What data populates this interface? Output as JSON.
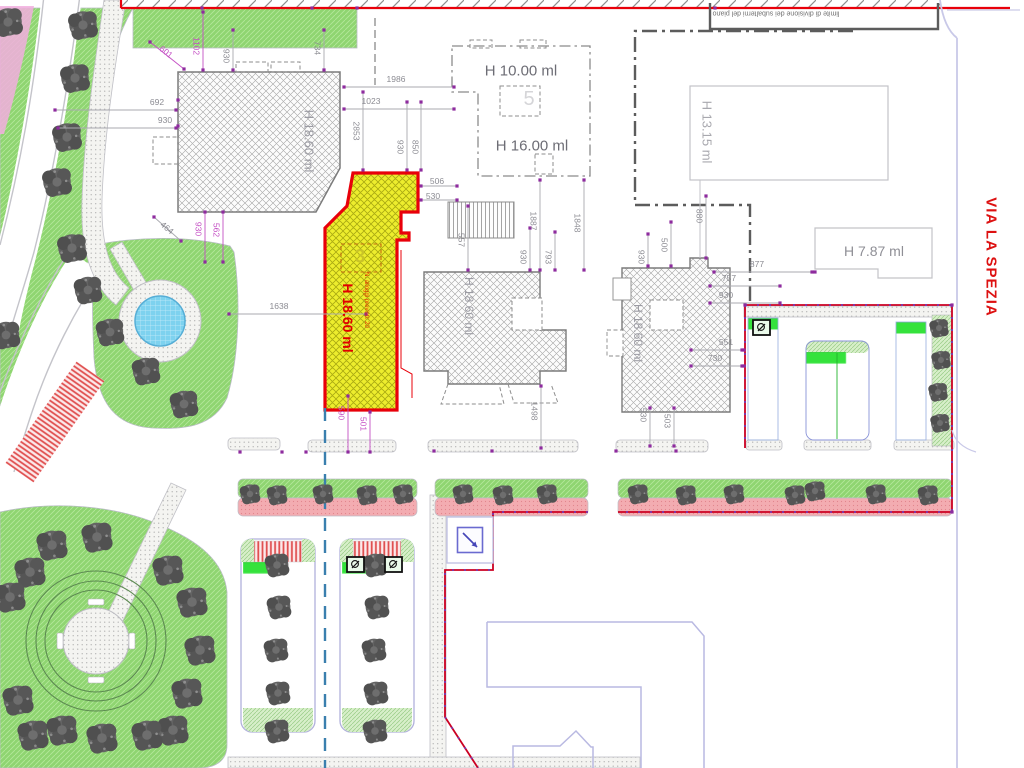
{
  "street": {
    "label": "VIA LA SPEZIA"
  },
  "boundary_note": {
    "text": "limite di divisione dei subalterni del piano"
  },
  "labels": [
    {
      "text": "H 18.60 ml",
      "x": 309,
      "y": 141,
      "rot": 90,
      "size": 13,
      "color": "#9b9ba3",
      "name": "building-nw-height-label"
    },
    {
      "text": "H 10.00 ml",
      "x": 521,
      "y": 71,
      "rot": 0,
      "size": 15,
      "color": "#6d6d75",
      "name": "building-h10-height-label"
    },
    {
      "text": "H 16.00 ml",
      "x": 532,
      "y": 146,
      "rot": 0,
      "size": 15,
      "color": "#6d6d75",
      "name": "building-h16-height-label"
    },
    {
      "text": "H 13.15 ml",
      "x": 707,
      "y": 132,
      "rot": 90,
      "size": 13,
      "color": "#a8a8ae",
      "name": "building-h1315-height-label"
    },
    {
      "text": "H 7.87 ml",
      "x": 874,
      "y": 251,
      "rot": 0,
      "size": 14,
      "color": "#8f8f96",
      "name": "building-h787-height-label"
    },
    {
      "text": "H 18.60 ml",
      "x": 469,
      "y": 306,
      "rot": 90,
      "size": 12,
      "color": "#9b9ba3",
      "name": "building-center-height-label"
    },
    {
      "text": "H 18.60 ml",
      "x": 638,
      "y": 333,
      "rot": 90,
      "size": 12,
      "color": "#9b9ba3",
      "name": "building-east-height-label"
    },
    {
      "text": "H 18.60 ml",
      "x": 348,
      "y": 318,
      "rot": 90,
      "size": 14,
      "color": "#e10000",
      "bold": true,
      "name": "new-building-height-label"
    },
    {
      "text": "N. alloggi previsti: 20",
      "x": 366,
      "y": 300,
      "rot": 90,
      "size": 6,
      "color": "#e13000",
      "name": "new-building-note"
    },
    {
      "text": "3",
      "x": 360,
      "y": 257,
      "rot": 0,
      "size": 19,
      "color": "#c9c427",
      "bold": true,
      "name": "unit-number-3"
    },
    {
      "text": "5",
      "x": 529,
      "y": 99,
      "rot": 0,
      "size": 20,
      "color": "#d5d5d8",
      "name": "unit-number-5"
    },
    {
      "text": "VIA LA SPEZIA",
      "x": 991,
      "y": 257,
      "rot": 90,
      "size": 15,
      "color": "#dd1111",
      "bold": true,
      "ls": 1,
      "name": "street-name-label"
    },
    {
      "text": "limite di divisione dei subalterni del piano",
      "x": 776,
      "y": 13,
      "rot": 180,
      "size": 7,
      "color": "#707070",
      "name": "division-boundary-note"
    }
  ],
  "dimensions": [
    {
      "t": "601",
      "x": 166,
      "y": 52,
      "r": 38,
      "c": "m",
      "l": [
        150,
        42,
        184,
        69
      ]
    },
    {
      "t": "1102",
      "x": 196,
      "y": 46,
      "r": 90,
      "c": "m",
      "l": [
        203,
        12,
        203,
        70
      ]
    },
    {
      "t": "930",
      "x": 226,
      "y": 56,
      "r": 90,
      "c": "g",
      "l": [
        233,
        30,
        233,
        70
      ]
    },
    {
      "t": "734",
      "x": 317,
      "y": 48,
      "r": 90,
      "c": "g",
      "l": [
        324,
        30,
        324,
        70
      ]
    },
    {
      "t": "692",
      "x": 157,
      "y": 102,
      "r": 0,
      "c": "g",
      "l": [
        55,
        110,
        176,
        110
      ]
    },
    {
      "t": "930",
      "x": 165,
      "y": 120,
      "r": 0,
      "c": "g",
      "l": [
        58,
        128,
        176,
        128
      ]
    },
    {
      "t": "1986",
      "x": 396,
      "y": 79,
      "r": 0,
      "c": "g",
      "l": [
        344,
        87,
        454,
        87
      ]
    },
    {
      "t": "1023",
      "x": 371,
      "y": 101,
      "r": 0,
      "c": "g",
      "l": [
        344,
        109,
        454,
        109
      ]
    },
    {
      "t": "2853",
      "x": 356,
      "y": 131,
      "r": 90,
      "c": "g",
      "l": [
        363,
        92,
        363,
        170
      ]
    },
    {
      "t": "930",
      "x": 400,
      "y": 147,
      "r": 90,
      "c": "g",
      "l": [
        407,
        102,
        407,
        170
      ]
    },
    {
      "t": "850",
      "x": 415,
      "y": 147,
      "r": 90,
      "c": "g",
      "l": [
        421,
        102,
        421,
        170
      ]
    },
    {
      "t": "506",
      "x": 437,
      "y": 181,
      "r": 0,
      "c": "g",
      "l": [
        421,
        186,
        457,
        186
      ]
    },
    {
      "t": "530",
      "x": 433,
      "y": 196,
      "r": 0,
      "c": "g",
      "l": [
        421,
        200,
        457,
        200
      ]
    },
    {
      "t": "464",
      "x": 167,
      "y": 228,
      "r": 40,
      "c": "g",
      "l": [
        154,
        217,
        181,
        241
      ]
    },
    {
      "t": "930",
      "x": 198,
      "y": 229,
      "r": 90,
      "c": "m",
      "l": [
        205,
        212,
        205,
        262
      ]
    },
    {
      "t": "562",
      "x": 216,
      "y": 230,
      "r": 90,
      "c": "m",
      "l": [
        223,
        212,
        223,
        262
      ]
    },
    {
      "t": "1638",
      "x": 279,
      "y": 306,
      "r": 0,
      "c": "g",
      "l": [
        229,
        314,
        366,
        314
      ]
    },
    {
      "t": "557",
      "x": 461,
      "y": 240,
      "r": 90,
      "c": "g",
      "l": [
        468,
        206,
        468,
        270
      ]
    },
    {
      "t": "930",
      "x": 523,
      "y": 257,
      "r": 90,
      "c": "g",
      "l": [
        530,
        228,
        530,
        270
      ]
    },
    {
      "t": "793",
      "x": 548,
      "y": 257,
      "r": 90,
      "c": "g",
      "l": [
        555,
        232,
        555,
        270
      ]
    },
    {
      "t": "1887",
      "x": 533,
      "y": 221,
      "r": 90,
      "c": "g",
      "l": [
        540,
        180,
        540,
        270
      ]
    },
    {
      "t": "1848",
      "x": 577,
      "y": 223,
      "r": 90,
      "c": "g",
      "l": [
        584,
        180,
        584,
        270
      ]
    },
    {
      "t": "1498",
      "x": 534,
      "y": 411,
      "r": 90,
      "c": "g",
      "l": [
        541,
        386,
        541,
        448
      ]
    },
    {
      "t": "500",
      "x": 664,
      "y": 245,
      "r": 90,
      "c": "g",
      "l": [
        671,
        222,
        671,
        266
      ]
    },
    {
      "t": "930",
      "x": 641,
      "y": 257,
      "r": 90,
      "c": "g",
      "l": [
        648,
        234,
        648,
        266
      ]
    },
    {
      "t": "880",
      "x": 699,
      "y": 216,
      "r": 90,
      "c": "g",
      "l": [
        706,
        196,
        706,
        258
      ]
    },
    {
      "t": "877",
      "x": 757,
      "y": 264,
      "r": 0,
      "c": "g",
      "l": [
        714,
        272,
        812,
        272
      ]
    },
    {
      "t": "757",
      "x": 729,
      "y": 278,
      "r": 0,
      "c": "g",
      "l": [
        710,
        286,
        780,
        286
      ]
    },
    {
      "t": "930",
      "x": 726,
      "y": 295,
      "r": 0,
      "c": "g",
      "l": [
        710,
        303,
        780,
        303
      ]
    },
    {
      "t": "551",
      "x": 726,
      "y": 342,
      "r": 0,
      "c": "g",
      "l": [
        691,
        350,
        742,
        350
      ]
    },
    {
      "t": "730",
      "x": 715,
      "y": 358,
      "r": 0,
      "c": "g",
      "l": [
        691,
        366,
        742,
        366
      ]
    },
    {
      "t": "503",
      "x": 667,
      "y": 421,
      "r": 90,
      "c": "g",
      "l": [
        674,
        408,
        674,
        446
      ]
    },
    {
      "t": "530",
      "x": 643,
      "y": 415,
      "r": 90,
      "c": "g",
      "l": [
        650,
        408,
        650,
        446
      ]
    },
    {
      "t": "590",
      "x": 341,
      "y": 413,
      "r": 90,
      "c": "m",
      "l": [
        348,
        396,
        348,
        452
      ]
    },
    {
      "t": "501",
      "x": 363,
      "y": 424,
      "r": 90,
      "c": "m",
      "l": [
        370,
        412,
        370,
        452
      ]
    }
  ],
  "extra_dots": [
    [
      202,
      8
    ],
    [
      312,
      8
    ],
    [
      357,
      8
    ],
    [
      715,
      8
    ],
    [
      240,
      452
    ],
    [
      282,
      452
    ],
    [
      306,
      452
    ],
    [
      434,
      451
    ],
    [
      492,
      451
    ],
    [
      616,
      451
    ],
    [
      676,
      451
    ],
    [
      745,
      305
    ],
    [
      952,
      305
    ],
    [
      952,
      512
    ],
    [
      815,
      272
    ],
    [
      744,
      350
    ],
    [
      744,
      366
    ],
    [
      178,
      100
    ],
    [
      178,
      126
    ]
  ],
  "icons": [
    "parking-sign-icon",
    "transformer-cabin-icon",
    "tree-icon"
  ],
  "colors": {
    "boundary_red": "#e8000a",
    "parcel_red": "#cb0022",
    "dimension_gray": "#8b8b92",
    "dimension_magenta": "#c44fc4",
    "dot_purple": "#8e2b9e",
    "lawn_green": "#8fd571",
    "stall_green": "#35e23c",
    "pink_path": "#f3acb1",
    "pond_blue": "#7ed2ef",
    "dashed_blue": "#3a7fae",
    "outline_lavender": "#b9b9e2",
    "hatch_gray": "#a3a3a3",
    "tree_gray": "#5d5d5d",
    "street_red": "#dd1111",
    "yellow_fill": "#eded2d",
    "dark_line": "#5c5c5c"
  }
}
